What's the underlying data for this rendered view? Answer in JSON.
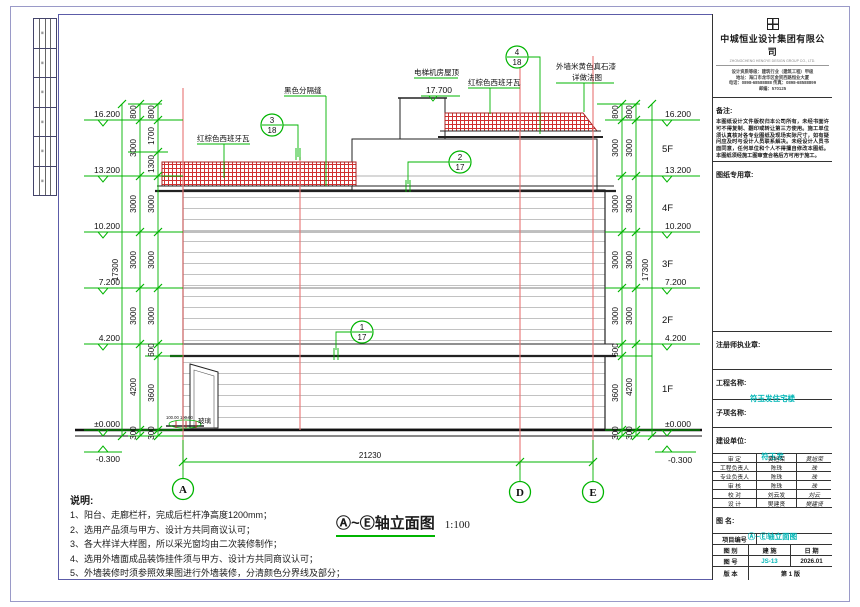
{
  "title_block": {
    "company": "中城恒业设计集团有限公司",
    "company_en": "ZHONGCHENG HENGYE DESIGN GROUP CO., LTD.",
    "address_lines": [
      "设计资质等级：建筑行业（建筑工程）甲级",
      "地址：海口市龙华区金贸西路恒业大厦",
      "电话：0898-68588888  传真：0898-68588899",
      "邮编：570125"
    ],
    "remark_label": "备注:",
    "remark_text": "本图纸设计文件版权归本公司所有，未经书面许可不得复制、翻印或转让第三方使用。施工单位须认真核对各专业图纸及现场实际尺寸，如有疑问应及时与设计人员联系解决。未经设计人员书面同意，任何单位和个人不得擅自修改本图纸。本图纸须经施工图审查合格后方可用于施工。",
    "seal_label": "图纸专用章:",
    "license_label": "注册师执业章:",
    "project_label": "工程名称:",
    "project_value": "符玉发住宅楼",
    "subitem_label": "子项名称:",
    "client_label": "建设单位:",
    "client_value": "符玉发",
    "staff_rows": [
      {
        "role": "审  定",
        "name": "黄旭荣",
        "sign": "黄旭荣"
      },
      {
        "role": "工程负责人",
        "name": "陈珠",
        "sign": "珠"
      },
      {
        "role": "专业负责人",
        "name": "陈珠",
        "sign": "珠"
      },
      {
        "role": "审  核",
        "name": "陈珠",
        "sign": "珠"
      },
      {
        "role": "校  对",
        "name": "刘云发",
        "sign": "刘云"
      },
      {
        "role": "设  计",
        "name": "樊建贤",
        "sign": "樊建贤"
      }
    ],
    "name_label": "图  名:",
    "name_value": "Ⓐ~Ⓔ轴立面图",
    "project_no_label": "项目编号",
    "type_label": "图  别",
    "type_value": "建  施",
    "date_label": "日  期",
    "date_value": "2026.01",
    "no_label": "图  号",
    "no_value": "JS-13",
    "ver_label": "版  本",
    "ver_value": "第 1 版"
  },
  "notes": {
    "title": "说明:",
    "items": [
      "1、阳台、走廊栏杆，完成后栏杆净高度1200mm；",
      "2、选用产品须与甲方、设计方共同商议认可；",
      "3、各大样详大样图，所以采光窗均由二次装修制作；",
      "4、选用外墙面成品装饰挂件须与甲方、设计方共同商议认可；",
      "5、外墙装修时须参照效果图进行外墙装修，分清颜色分界线及部分；"
    ]
  },
  "drawing": {
    "title": "Ⓐ~Ⓔ轴立面图",
    "scale": "1:100",
    "axes": [
      "A",
      "D",
      "E"
    ],
    "overall_width": "21230",
    "overall_height": "17300",
    "levels": [
      "16.200",
      "13.200",
      "10.200",
      "7.200",
      "4.200",
      "±0.000",
      "-0.300"
    ],
    "floors": [
      "5F",
      "4F",
      "3F",
      "2F",
      "1F"
    ],
    "dims": {
      "left_col1": [
        "800",
        "3000",
        "3000",
        "3000",
        "3000",
        "4200",
        "300"
      ],
      "left_col2": [
        "800",
        "1700",
        "1300",
        "3000",
        "3000",
        "3000",
        "600",
        "3600",
        "300"
      ],
      "right_col1": [
        "800",
        "3000",
        "3000",
        "3000",
        "3000",
        "600",
        "3600",
        "300"
      ],
      "right_col2": [
        "800",
        "3000",
        "3000",
        "3000",
        "3000",
        "4200",
        "300"
      ]
    },
    "bubbles": [
      {
        "n": "3",
        "d": "18"
      },
      {
        "n": "4",
        "d": "18"
      },
      {
        "n": "2",
        "d": "17"
      },
      {
        "n": "1",
        "d": "17"
      }
    ],
    "labels": {
      "machine_room": "电梯机房屋顶",
      "machine_room_level": "17.700",
      "black_seam": "黑色分隔缝",
      "tile_left": "红棕色西班牙瓦",
      "tile_right": "红棕色西班牙瓦",
      "wall_paint_line1": "外墙米黄色真石漆",
      "wall_paint_line2": "详做法图",
      "glass": "玻璃",
      "canopy_dims": "100.00 100.00"
    }
  }
}
